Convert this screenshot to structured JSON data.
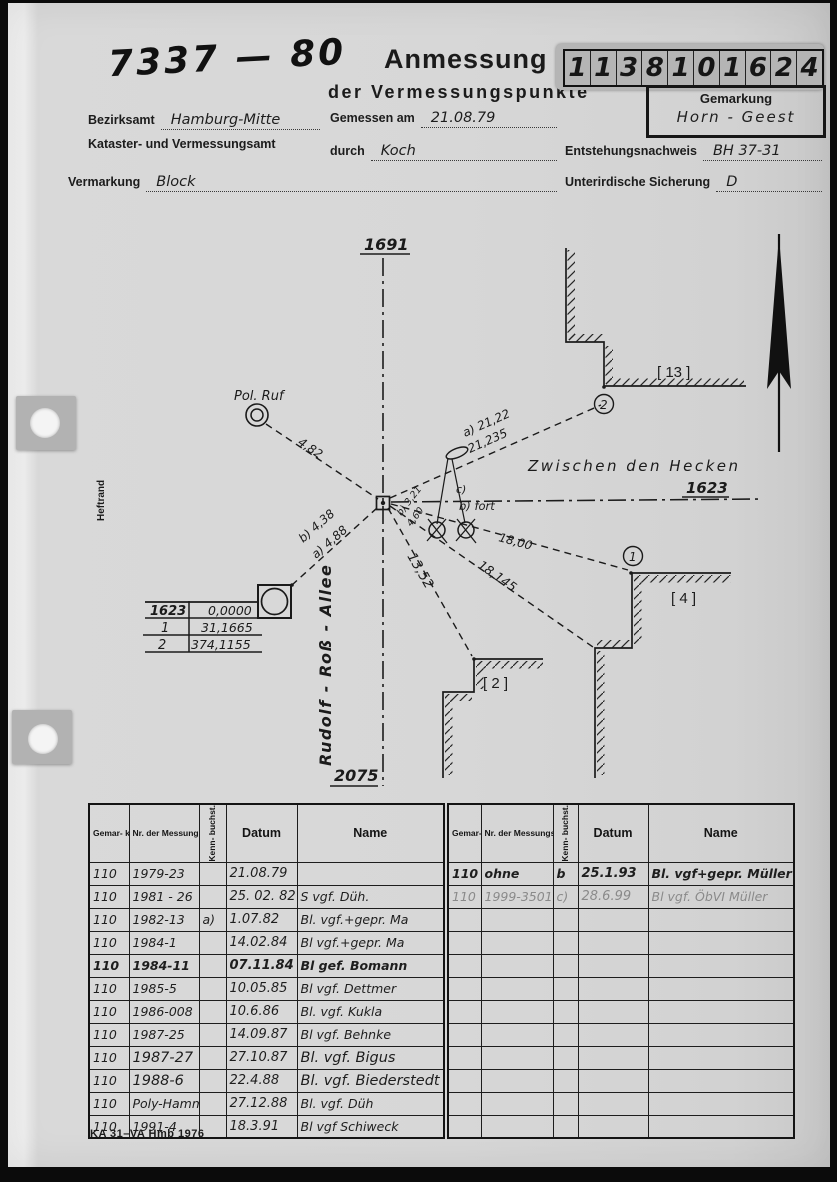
{
  "colors": {
    "paper": "#d6d6d6",
    "ink": "#1a1a1a",
    "pencil": "#8a8a8a",
    "stamp_bg": "#b5b5b5"
  },
  "header": {
    "file_number": "7337 — 80",
    "title": "Anmessung",
    "subtitle": "der Vermessungspunkte",
    "stamp_digits": [
      "1",
      "1",
      "3",
      "8",
      "1",
      "0",
      "1",
      "6",
      "2",
      "4"
    ],
    "gemarkung_label": "Gemarkung",
    "gemarkung_value": "Horn - Geest",
    "bezirksamt_label": "Bezirksamt",
    "bezirksamt_value": "Hamburg-Mitte",
    "amt_line2": "Kataster- und Vermessungsamt",
    "gemessen_label": "Gemessen am",
    "gemessen_value": "21.08.79",
    "durch_label": "durch",
    "durch_value": "Koch",
    "entstehung_label": "Entstehungsnachweis",
    "entstehung_value": "BH 37-31",
    "vermarkung_label": "Vermarkung",
    "vermarkung_value": "Block",
    "sicherung_label": "Unterirdische Sicherung",
    "sicherung_value": "D"
  },
  "sketch": {
    "margin_label": "Heftrand",
    "label_top": "1691",
    "label_bottom": "2075",
    "street_right_label": "1623",
    "street_h": "Zwischen den Hecken",
    "street_v": "Rudolf - Roß - Allee",
    "pol_ruf": "Pol. Ruf",
    "d482": "4,82",
    "a2122": "a) 21,22",
    "d21235": "21,235",
    "d1800": "18,00",
    "d18145": "18,145",
    "d1352": "13,52",
    "b438": "b) 4,38",
    "a488": "a) 4,88",
    "b321": "b) 3,21",
    "d460": "4,60",
    "note_c": "c)",
    "note_bfort": "b) fort",
    "br13": "[ 13 ]",
    "br4": "[ 4 ]",
    "br2": "[ 2 ]",
    "p1": "1",
    "p2": "2",
    "bearing_rows": [
      [
        "1623",
        "0,0000"
      ],
      [
        "1",
        "31,1665"
      ],
      [
        "2",
        "374,1155"
      ]
    ]
  },
  "tables": {
    "headers": {
      "col1": "Gemar- kungs- schlüssel",
      "col2": "Nr. der Messungssache",
      "col3": "Kenn- buchst.",
      "col4": "Datum",
      "col5": "Name"
    },
    "left_rows": [
      [
        "110",
        "1979-23",
        "",
        "21.08.79",
        ""
      ],
      [
        "110",
        "1981 - 26",
        "",
        "25. 02. 82",
        "S vgf. Düh."
      ],
      [
        "110",
        "1982-13",
        "a)",
        "1.07.82",
        "Bl. vgf.+gepr. Ma"
      ],
      [
        "110",
        "1984-1",
        "",
        "14.02.84",
        "Bl vgf.+gepr. Ma"
      ],
      [
        "110",
        "1984-11",
        "",
        "07.11.84",
        "Bl gef. Bomann"
      ],
      [
        "110",
        "1985-5",
        "",
        "10.05.85",
        "Bl vgf. Dettmer"
      ],
      [
        "110",
        "1986-008",
        "",
        "10.6.86",
        "Bl. vgf. Kukla"
      ],
      [
        "110",
        "1987-25",
        "",
        "14.09.87",
        "Bl vgf. Behnke"
      ],
      [
        "110",
        "1987-27",
        "",
        "27.10.87",
        "Bl. vgf. Bigus"
      ],
      [
        "110",
        "1988-6",
        "",
        "22.4.88",
        "Bl. vgf. Biederstedt"
      ],
      [
        "110",
        "Poly-Hamm",
        "",
        "27.12.88",
        "Bl. vgf. Düh"
      ],
      [
        "110",
        "1991-4",
        "",
        "18.3.91",
        "Bl vgf Schiweck"
      ]
    ],
    "right_rows": [
      [
        "110",
        "ohne",
        "b",
        "25.1.93",
        "Bl. vgf+gepr. Müller"
      ],
      [
        "110",
        "1999-3501",
        "c)",
        "28.6.99",
        "Bl vgf. ÖbVI Müller"
      ]
    ]
  },
  "footer": {
    "form_code": "KA 31–VA Hmb 1976"
  }
}
